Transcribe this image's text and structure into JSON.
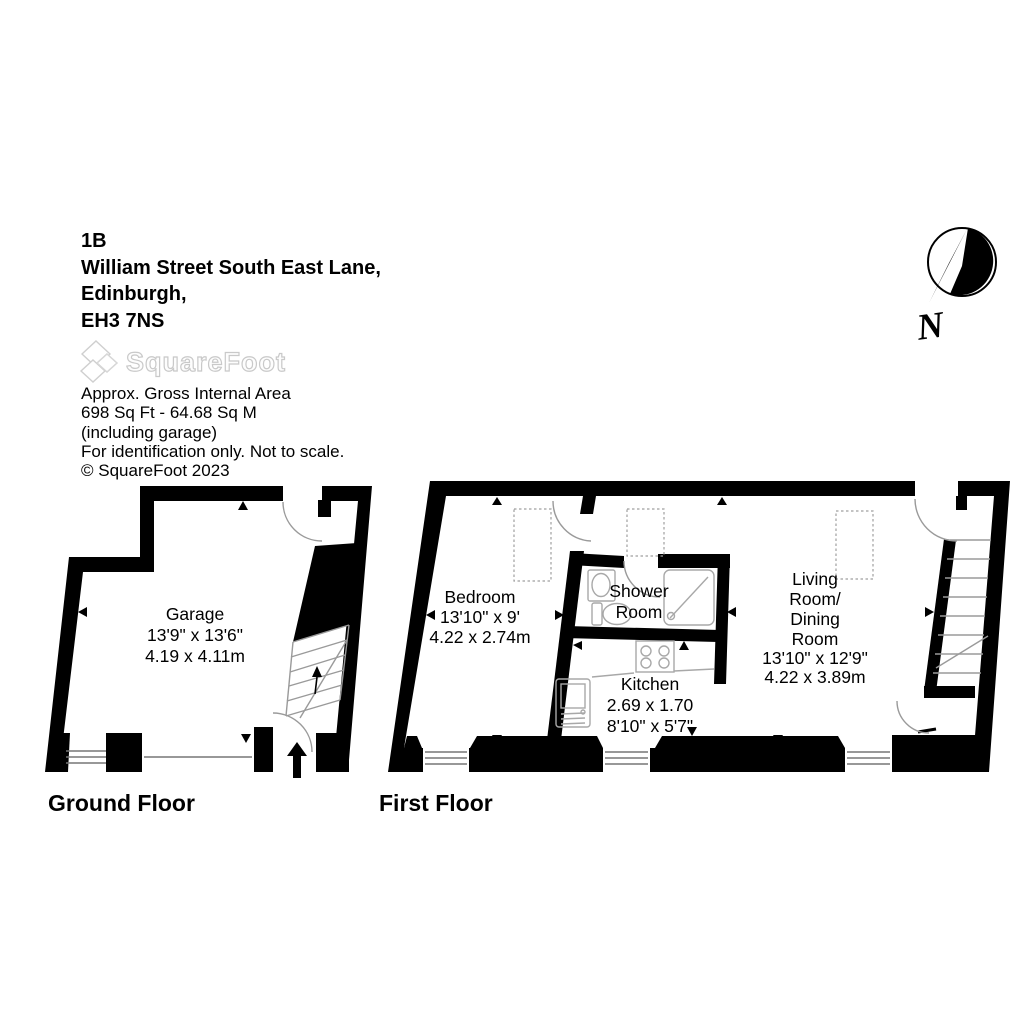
{
  "address": [
    "1B",
    "William Street South East Lane,",
    "Edinburgh,",
    "EH3 7NS"
  ],
  "logo": {
    "text": "SquareFoot"
  },
  "meta": [
    "Approx. Gross Internal Area",
    "698 Sq Ft  - 64.68 Sq M",
    "(including garage)",
    "For identification only. Not to scale.",
    "© SquareFoot 2023"
  ],
  "compass": {
    "label": "N"
  },
  "ground": {
    "label": "Ground Floor",
    "garage": {
      "name": "Garage",
      "imperial": "13'9\" x 13'6\"",
      "metric": "4.19 x 4.11m"
    }
  },
  "first": {
    "label": "First Floor",
    "bedroom": {
      "name": "Bedroom",
      "imperial": "13'10\" x 9'",
      "metric": "4.22 x 2.74m"
    },
    "shower": {
      "line1": "Shower",
      "line2": "Room"
    },
    "kitchen": {
      "name": "Kitchen",
      "metric": "2.69 x 1.70",
      "imperial": "8'10\" x 5'7\""
    },
    "living": {
      "line1": "Living",
      "line2": "Room/",
      "line3": "Dining",
      "line4": "Room",
      "imperial": "13'10\" x 12'9\"",
      "metric": "4.22 x 3.89m"
    }
  }
}
